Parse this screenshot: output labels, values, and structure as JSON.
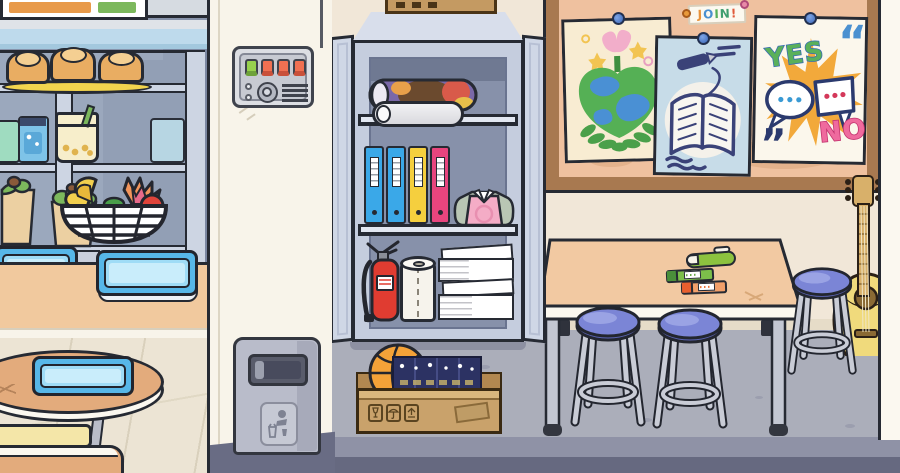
{
  "board": {
    "join_label": {
      "letters": [
        "J",
        "O",
        "I",
        "N",
        "!"
      ]
    },
    "poster_yes_no": {
      "yes": "YES",
      "no": "NO"
    }
  },
  "decor": {
    "open_quote": "“",
    "close_quote": "”"
  },
  "palette": {
    "outline": "#262a33",
    "wall_cafeteria": "#8793ab",
    "wall_cafeteria_shadow": "#7b87a1",
    "wall_classroom": "#f1e7d8",
    "pillar": "#f8f4ea",
    "board_frame": "#a87950",
    "board_cork": "#efc19f",
    "floor_classroom": "#abaeba",
    "floor_cafeteria": "#ece4d4",
    "floor_band_dark": "#666980",
    "tray_blue": "#57b7e8",
    "counter_wood": "#f1c99e",
    "table_wood": "#f2c9a2",
    "stool_seat": "#7b85d6",
    "binder_blue": "#3aa8e8",
    "binder_yellow": "#f5cf3e",
    "binder_pink": "#e8457e",
    "extinguisher_red": "#e03c31",
    "basketball_orange": "#f4a238",
    "cardboard": "#c9a26b",
    "guitar_body": "#f0da7c",
    "poster_earth_bg": "#f8ecd2",
    "poster_book_bg": "#c7dce8",
    "poster_vote_bg": "#fbf7ec",
    "yes_green": "#5ab05a",
    "no_pink": "#ef6a9e"
  }
}
